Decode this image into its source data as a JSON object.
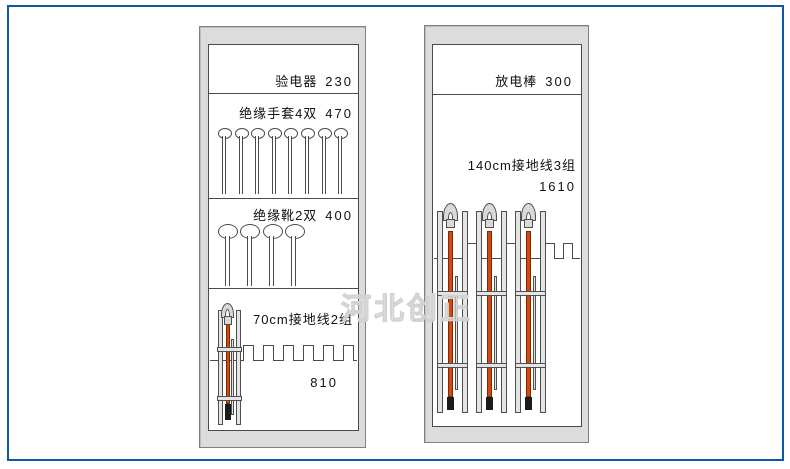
{
  "watermark": "河北创正",
  "colors": {
    "frame_blue": "#0d57a6",
    "cabinet_fill": "#dcdcdc",
    "line_dark": "#4a4a4a",
    "rod_orange": "#d3490e",
    "tip_black": "#1c1c1c"
  },
  "left_cabinet": {
    "sections": [
      {
        "label": "验电器",
        "value": "230"
      },
      {
        "label": "绝缘手套4双",
        "value": "470",
        "pegs": 8
      },
      {
        "label": "绝缘靴2双",
        "value": "400",
        "pegs": 4
      },
      {
        "label": "70cm接地线2组",
        "value": "810",
        "grounding_sets": 1,
        "comb_notches": 6
      }
    ]
  },
  "right_cabinet": {
    "sections": [
      {
        "label": "放电棒",
        "value": "300"
      },
      {
        "label": "140cm接地线3组",
        "value": "1610",
        "grounding_sets": 3,
        "comb_notches": 4
      }
    ]
  }
}
